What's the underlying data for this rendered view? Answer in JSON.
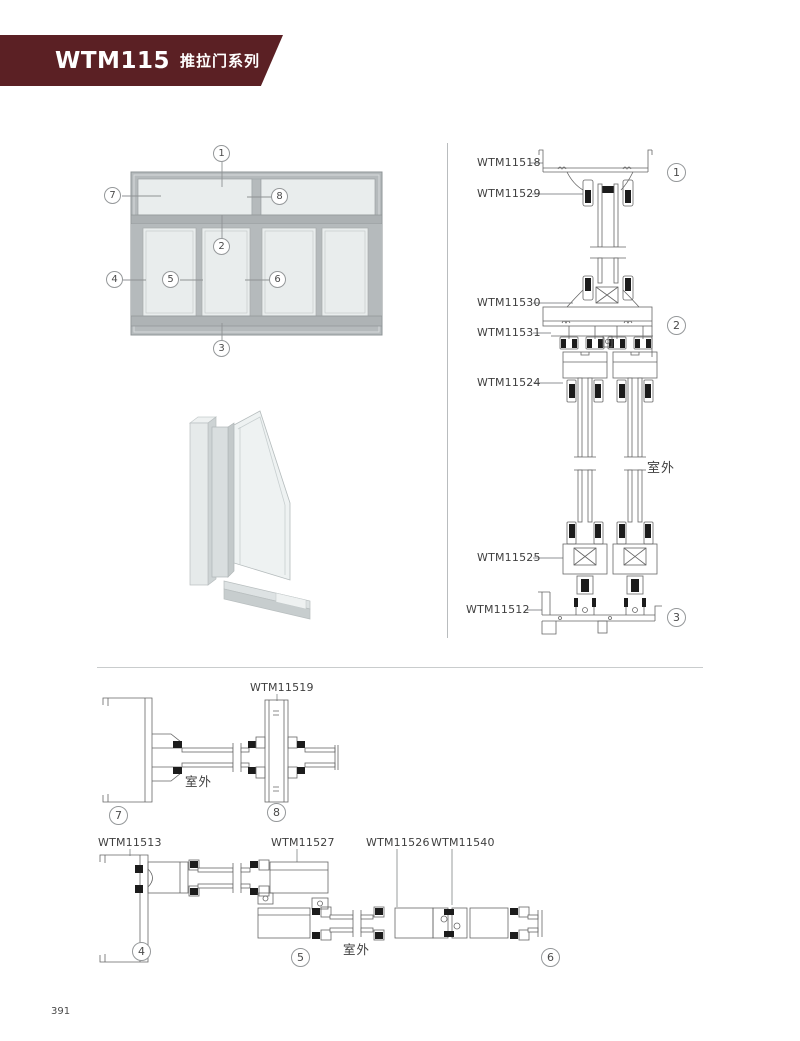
{
  "header": {
    "series_code": "WTM115",
    "series_name": "推拉门系列"
  },
  "page": {
    "number": "391"
  },
  "colors": {
    "banner": "#5B2024",
    "line_art": "#666666",
    "frame_gray": "#B5BABC",
    "glass_gray": "#E9EDED",
    "label_text": "#3F3F3F"
  },
  "elevation": {
    "callouts": {
      "c1": "1",
      "c2": "2",
      "c3": "3",
      "c4": "4",
      "c5": "5",
      "c6": "6",
      "c7": "7",
      "c8": "8"
    }
  },
  "vertical_section": {
    "labels": {
      "top_frame": "WTM11518",
      "top_bead": "WTM11529",
      "transom_beam": "WTM11530",
      "hanging_track": "WTM11531",
      "sash_top": "WTM11524",
      "sash_bottom": "WTM11525",
      "bottom_track": "WTM11512"
    },
    "outdoor_label": "室外",
    "callouts": {
      "c1": "1",
      "c2": "2",
      "c3": "3"
    }
  },
  "transom_section": {
    "labels": {
      "mullion": "WTM11519"
    },
    "outdoor_label": "室外",
    "callouts": {
      "c7": "7",
      "c8": "8"
    }
  },
  "bottom_section": {
    "labels": {
      "jamb": "WTM11513",
      "panel": "WTM11527",
      "sash": "WTM11526",
      "meeting_stile": "WTM11540"
    },
    "outdoor_label": "室外",
    "callouts": {
      "c4": "4",
      "c5": "5",
      "c6": "6"
    }
  }
}
